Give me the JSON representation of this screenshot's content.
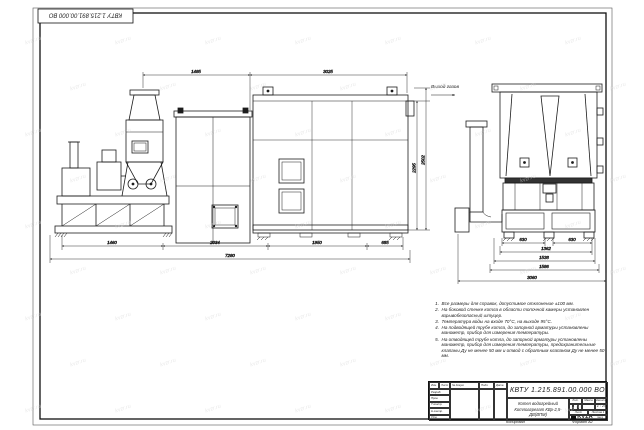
{
  "colors": {
    "line": "#1c1c1c",
    "watermark": "#d7d7d7"
  },
  "watermark": {
    "text": "kvzr.ru"
  },
  "drawing": {
    "gas_outlet_label": "Выход газов",
    "side_view": {
      "dims_top": [
        "1485",
        "3025"
      ],
      "dims_right": [
        "2295",
        "2502"
      ],
      "dims_bottom": [
        "1460",
        "2034",
        "1950",
        "685"
      ],
      "dim_overall": "7280"
    },
    "end_view": {
      "dims_top_row": [
        "630",
        "630"
      ],
      "dims_stacked": [
        "1362",
        "1538",
        "1586"
      ],
      "dim_overall": "3060"
    }
  },
  "notes": {
    "items": [
      {
        "num": "1.",
        "text": "Все размеры для справок, допустимое отклонение ±100 мм."
      },
      {
        "num": "2.",
        "text": "На боковой стенке котла в области топочной камеры установлен взрывобезопасный штуцер."
      },
      {
        "num": "3.",
        "text": "Температура воды на входе 70°С, на выходе 95°С."
      },
      {
        "num": "4.",
        "text": "На подводящей трубе котла, до запорной арматуры установлены манометр, прибор для измерения температуры."
      },
      {
        "num": "5.",
        "text": "На отводящей трубе котла, до запорной арматуры установлены манометр, прибор для измерения температуры, предохранительные клапаны Ду не менее 50 мм и отвод с обратным клапаном Ду не менее 50 мм."
      }
    ]
  },
  "title_block": {
    "doc_number": "КВТУ 1.215.891.00.000 ВО",
    "title_line1": "Котел водогрейный",
    "title_line2": "Котлоагрегат КВр-2,5-ДВ(ВПМ)",
    "header_cols": [
      "Изм.",
      "Лист",
      "№ докум.",
      "Подп.",
      "Дата"
    ],
    "approval_rows": [
      "Разраб.",
      "Пров.",
      "Т.контр.",
      "Н.контр.",
      "Утв."
    ],
    "lit_label": "Лит.",
    "mass_label": "Масса",
    "scale_label": "Масштаб",
    "scale_value": "1 : 25",
    "sheet_label": "Лист",
    "sheets_label": "Листов",
    "sheets_value": "1",
    "company": "KVZR",
    "company_sub1": "КОТЕЛЬНЫЙ",
    "company_sub2": "ЗАВОД"
  },
  "footer": {
    "copied_label": "Копировал",
    "format_label": "Формат А2"
  }
}
